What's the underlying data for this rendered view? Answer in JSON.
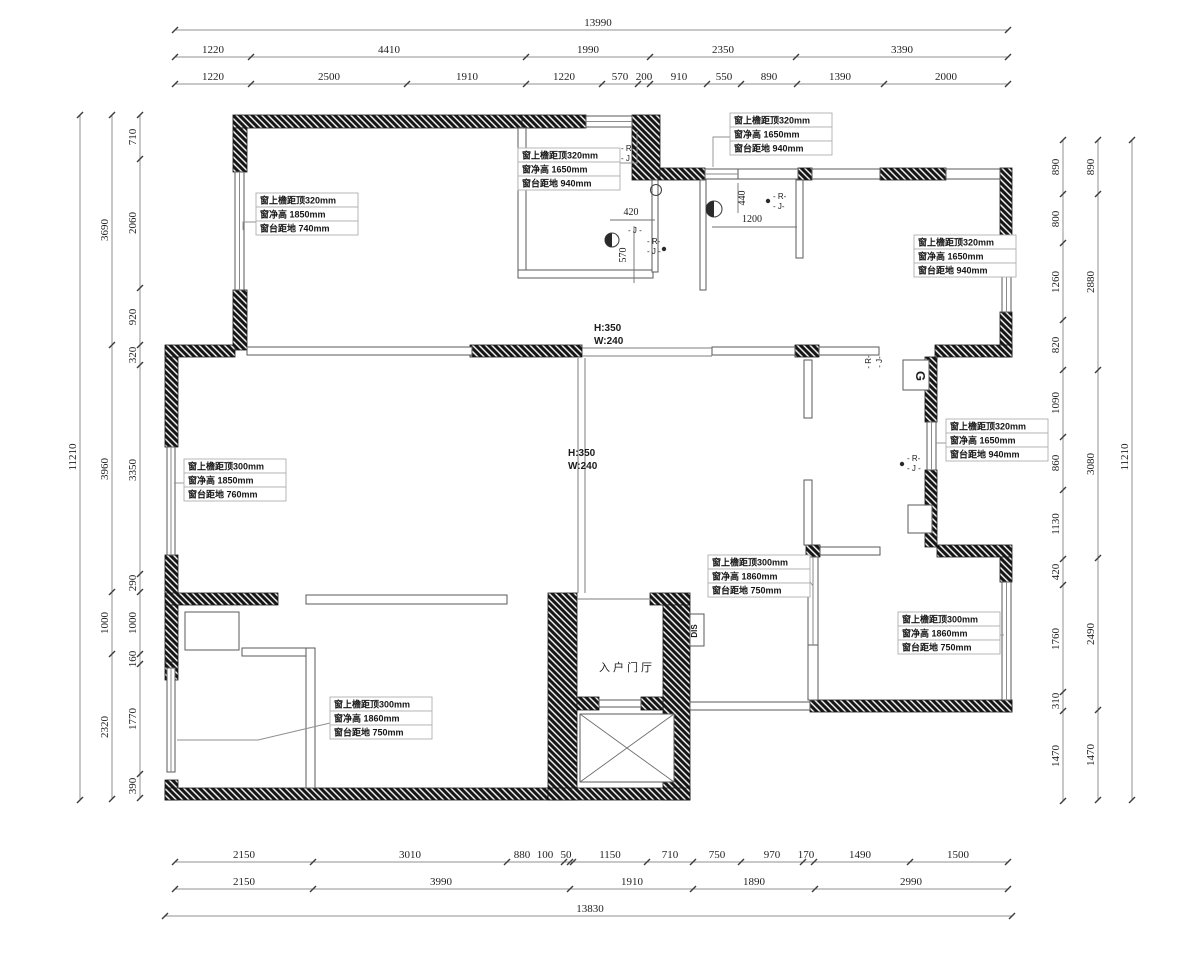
{
  "drawing": {
    "room_label": "入户门厅",
    "dis_label": "DIS",
    "gas_label": "G"
  },
  "dim_rows": [
    {
      "n": "dim-top-overall",
      "o": "h",
      "p": 30,
      "a": 175,
      "b": 1008,
      "ticks": [
        175,
        1008
      ],
      "labels": [
        {
          "t": "13990",
          "c": 598
        }
      ]
    },
    {
      "n": "dim-top-major",
      "o": "h",
      "p": 57,
      "a": 175,
      "b": 1008,
      "ticks": [
        175,
        251,
        526,
        650,
        796,
        1008
      ],
      "labels": [
        {
          "t": "1220",
          "c": 213
        },
        {
          "t": "4410",
          "c": 389
        },
        {
          "t": "1990",
          "c": 588
        },
        {
          "t": "2350",
          "c": 723
        },
        {
          "t": "3390",
          "c": 902
        }
      ]
    },
    {
      "n": "dim-top-minor",
      "o": "h",
      "p": 84,
      "a": 175,
      "b": 1008,
      "ticks": [
        175,
        251,
        407,
        526,
        602,
        638,
        650,
        707,
        741,
        797,
        884,
        1008
      ],
      "labels": [
        {
          "t": "1220",
          "c": 213
        },
        {
          "t": "2500",
          "c": 329
        },
        {
          "t": "1910",
          "c": 467
        },
        {
          "t": "1220",
          "c": 564
        },
        {
          "t": "570",
          "c": 620
        },
        {
          "t": "200",
          "c": 644
        },
        {
          "t": "910",
          "c": 679
        },
        {
          "t": "550",
          "c": 724
        },
        {
          "t": "890",
          "c": 769
        },
        {
          "t": "1390",
          "c": 840
        },
        {
          "t": "2000",
          "c": 946
        }
      ]
    },
    {
      "n": "dim-bottom-minor",
      "o": "h",
      "p": 862,
      "a": 175,
      "b": 1008,
      "ticks": [
        175,
        313,
        507,
        564,
        570,
        573,
        647,
        693,
        741,
        803,
        814,
        910,
        1008
      ],
      "labels": [
        {
          "t": "2150",
          "c": 244
        },
        {
          "t": "3010",
          "c": 410
        },
        {
          "t": "880",
          "c": 522
        },
        {
          "t": "100",
          "c": 545
        },
        {
          "t": "50",
          "c": 566
        },
        {
          "t": "1150",
          "c": 610
        },
        {
          "t": "710",
          "c": 670
        },
        {
          "t": "750",
          "c": 717
        },
        {
          "t": "970",
          "c": 772
        },
        {
          "t": "170",
          "c": 806
        },
        {
          "t": "1490",
          "c": 860
        },
        {
          "t": "1500",
          "c": 958
        }
      ]
    },
    {
      "n": "dim-bottom-major",
      "o": "h",
      "p": 889,
      "a": 175,
      "b": 1008,
      "ticks": [
        175,
        313,
        570,
        693,
        815,
        1008
      ],
      "labels": [
        {
          "t": "2150",
          "c": 244
        },
        {
          "t": "3990",
          "c": 441
        },
        {
          "t": "1910",
          "c": 632
        },
        {
          "t": "1890",
          "c": 754
        },
        {
          "t": "2990",
          "c": 911
        }
      ]
    },
    {
      "n": "dim-bottom-overall",
      "o": "h",
      "p": 916,
      "a": 165,
      "b": 1012,
      "ticks": [
        165,
        1012
      ],
      "labels": [
        {
          "t": "13830",
          "c": 590
        }
      ]
    },
    {
      "n": "dim-left-overall",
      "o": "v",
      "p": 80,
      "a": 115,
      "b": 800,
      "ticks": [
        115,
        800
      ],
      "labels": [
        {
          "t": "11210",
          "c": 457
        }
      ]
    },
    {
      "n": "dim-left-major",
      "o": "v",
      "p": 112,
      "a": 115,
      "b": 799,
      "ticks": [
        115,
        345,
        592,
        654,
        799
      ],
      "labels": [
        {
          "t": "3690",
          "c": 230
        },
        {
          "t": "3960",
          "c": 469
        },
        {
          "t": "1000",
          "c": 623
        },
        {
          "t": "2320",
          "c": 727
        }
      ]
    },
    {
      "n": "dim-left-minor",
      "o": "v",
      "p": 140,
      "a": 115,
      "b": 798,
      "ticks": [
        115,
        159,
        288,
        345,
        365,
        574,
        592,
        654,
        664,
        774,
        798
      ],
      "labels": [
        {
          "t": "710",
          "c": 137
        },
        {
          "t": "2060",
          "c": 223
        },
        {
          "t": "920",
          "c": 317
        },
        {
          "t": "320",
          "c": 355
        },
        {
          "t": "3350",
          "c": 470
        },
        {
          "t": "290",
          "c": 583
        },
        {
          "t": "1000",
          "c": 623
        },
        {
          "t": "160",
          "c": 659
        },
        {
          "t": "1770",
          "c": 719
        },
        {
          "t": "390",
          "c": 786
        }
      ]
    },
    {
      "n": "dim-right-minor",
      "o": "v",
      "p": 1063,
      "a": 140,
      "b": 801,
      "ticks": [
        140,
        194,
        243,
        320,
        370,
        437,
        490,
        559,
        585,
        692,
        711,
        801
      ],
      "labels": [
        {
          "t": "890",
          "c": 167
        },
        {
          "t": "800",
          "c": 219
        },
        {
          "t": "1260",
          "c": 282
        },
        {
          "t": "820",
          "c": 345
        },
        {
          "t": "1090",
          "c": 403
        },
        {
          "t": "860",
          "c": 463
        },
        {
          "t": "1130",
          "c": 524
        },
        {
          "t": "420",
          "c": 572
        },
        {
          "t": "1760",
          "c": 639
        },
        {
          "t": "310",
          "c": 701
        },
        {
          "t": "1470",
          "c": 756
        }
      ]
    },
    {
      "n": "dim-right-major",
      "o": "v",
      "p": 1098,
      "a": 140,
      "b": 800,
      "ticks": [
        140,
        194,
        370,
        558,
        710,
        800
      ],
      "labels": [
        {
          "t": "890",
          "c": 167
        },
        {
          "t": "2880",
          "c": 282
        },
        {
          "t": "3080",
          "c": 464
        },
        {
          "t": "2490",
          "c": 634
        },
        {
          "t": "1470",
          "c": 755
        }
      ]
    },
    {
      "n": "dim-right-overall",
      "o": "v",
      "p": 1132,
      "a": 140,
      "b": 800,
      "ticks": [
        140,
        800
      ],
      "labels": [
        {
          "t": "11210",
          "c": 457
        }
      ]
    }
  ],
  "labels": [
    {
      "n": "inner-dim-420",
      "t": "420",
      "x": 631,
      "y": 215,
      "s": 10,
      "f": "serif",
      "a": "middle"
    },
    {
      "n": "inner-dim-570",
      "t": "570",
      "x": 626,
      "y": 255,
      "s": 10,
      "f": "serif",
      "a": "middle",
      "r": -90
    },
    {
      "n": "inner-dim-440",
      "t": "440",
      "x": 745,
      "y": 198,
      "s": 10,
      "f": "serif",
      "a": "middle",
      "r": -90
    },
    {
      "n": "inner-dim-1200",
      "t": "1200",
      "x": 752,
      "y": 222,
      "s": 10,
      "f": "serif",
      "a": "middle"
    },
    {
      "n": "beam1-h",
      "t": "H:350",
      "x": 594,
      "y": 331,
      "s": 10,
      "f": "sans",
      "w": 700,
      "a": "start"
    },
    {
      "n": "beam1-w",
      "t": "W:240",
      "x": 594,
      "y": 344,
      "s": 10,
      "f": "sans",
      "w": 700,
      "a": "start"
    },
    {
      "n": "beam2-h",
      "t": "H:350",
      "x": 568,
      "y": 456,
      "s": 10,
      "f": "sans",
      "w": 700,
      "a": "start"
    },
    {
      "n": "beam2-w",
      "t": "W:240",
      "x": 568,
      "y": 469,
      "s": 10,
      "f": "sans",
      "w": 700,
      "a": "start"
    },
    {
      "n": "room-label-foyer",
      "t": "入户门厅",
      "x": 627,
      "y": 671,
      "s": 11,
      "f": "sans",
      "a": "middle",
      "ls": 3
    },
    {
      "n": "dis-label",
      "t": "DIS",
      "x": 697,
      "y": 631,
      "s": 8,
      "f": "sans",
      "w": 700,
      "a": "middle",
      "r": -90
    },
    {
      "n": "gas-label",
      "t": "G",
      "x": 916,
      "y": 376,
      "s": 13,
      "f": "sans",
      "w": 700,
      "a": "middle",
      "r": 90
    },
    {
      "n": "rj-a-r",
      "t": "- R-",
      "x": 621,
      "y": 151,
      "s": 8,
      "f": "sans",
      "a": "start"
    },
    {
      "n": "rj-a-j",
      "t": "- J -",
      "x": 621,
      "y": 161,
      "s": 8,
      "f": "sans",
      "a": "start"
    },
    {
      "n": "rj-b-r",
      "t": "- R-",
      "x": 647,
      "y": 244,
      "s": 8,
      "f": "sans",
      "a": "start"
    },
    {
      "n": "rj-b-j",
      "t": "- J -",
      "x": 647,
      "y": 254,
      "s": 8,
      "f": "sans",
      "a": "start"
    },
    {
      "n": "rj-c-r",
      "t": "- R-",
      "x": 773,
      "y": 199,
      "s": 8,
      "f": "sans",
      "a": "start"
    },
    {
      "n": "rj-c-j",
      "t": "- J-",
      "x": 773,
      "y": 209,
      "s": 8,
      "f": "sans",
      "a": "start"
    },
    {
      "n": "rj-d-r",
      "t": "- R-",
      "x": 907,
      "y": 461,
      "s": 8,
      "f": "sans",
      "a": "start"
    },
    {
      "n": "rj-d-j",
      "t": "- J -",
      "x": 907,
      "y": 471,
      "s": 8,
      "f": "sans",
      "a": "start"
    },
    {
      "n": "rj-e-r",
      "t": "- R-",
      "x": 871,
      "y": 362,
      "s": 8,
      "f": "sans",
      "a": "middle",
      "r": -90
    },
    {
      "n": "rj-e-j",
      "t": "- J-",
      "x": 882,
      "y": 362,
      "s": 8,
      "f": "sans",
      "a": "middle",
      "r": -90
    },
    {
      "n": "jlabel-420",
      "t": "- J -",
      "x": 628,
      "y": 233,
      "s": 8,
      "f": "sans",
      "a": "start"
    }
  ],
  "annotations": [
    {
      "n": "window-annotation-1",
      "x": 256,
      "y": 193,
      "lines": [
        "窗上檐距顶320mm",
        "窗净高  1850mm",
        "窗台距地  740mm"
      ],
      "leader": [
        [
          256,
          222
        ],
        [
          243,
          222
        ],
        [
          243,
          230
        ]
      ]
    },
    {
      "n": "window-annotation-2",
      "x": 518,
      "y": 148,
      "lines": [
        "窗上檐距顶320mm",
        "窗净高  1650mm",
        "窗台距地  940mm"
      ],
      "leader": [
        [
          620,
          163
        ],
        [
          637,
          163
        ],
        [
          637,
          131
        ]
      ]
    },
    {
      "n": "window-annotation-3",
      "x": 730,
      "y": 113,
      "lines": [
        "窗上檐距顶320mm",
        "窗净高  1650mm",
        "窗台距地  940mm"
      ],
      "leader": [
        [
          730,
          137
        ],
        [
          713,
          137
        ],
        [
          713,
          167
        ]
      ]
    },
    {
      "n": "window-annotation-4",
      "x": 914,
      "y": 235,
      "lines": [
        "窗上檐距顶320mm",
        "窗净高  1650mm",
        "窗台距地  940mm"
      ],
      "leader": [
        [
          1014,
          259
        ],
        [
          1004,
          259
        ]
      ]
    },
    {
      "n": "window-annotation-5",
      "x": 946,
      "y": 419,
      "lines": [
        "窗上檐距顶320mm",
        "窗净高  1650mm",
        "窗台距地  940mm"
      ],
      "leader": [
        [
          946,
          443
        ],
        [
          936,
          443
        ]
      ]
    },
    {
      "n": "window-annotation-6",
      "x": 184,
      "y": 459,
      "lines": [
        "窗上檐距顶300mm",
        "窗净高  1850mm",
        "窗台距地  760mm"
      ],
      "leader": [
        [
          184,
          483
        ],
        [
          174,
          483
        ]
      ]
    },
    {
      "n": "window-annotation-7",
      "x": 708,
      "y": 555,
      "lines": [
        "窗上檐距顶300mm",
        "窗净高  1860mm",
        "窗台距地  750mm"
      ],
      "leader": [
        [
          808,
          579
        ],
        [
          813,
          586
        ]
      ]
    },
    {
      "n": "window-annotation-8",
      "x": 898,
      "y": 612,
      "lines": [
        "窗上檐距顶300mm",
        "窗净高  1860mm",
        "窗台距地  750mm"
      ],
      "leader": [
        [
          998,
          635
        ],
        [
          1004,
          635
        ]
      ]
    },
    {
      "n": "window-annotation-9",
      "x": 330,
      "y": 697,
      "lines": [
        "窗上檐距顶300mm",
        "窗净高  1860mm",
        "窗台距地  750mm"
      ],
      "leader": [
        [
          330,
          723
        ],
        [
          258,
          740
        ],
        [
          177,
          740
        ]
      ]
    }
  ]
}
